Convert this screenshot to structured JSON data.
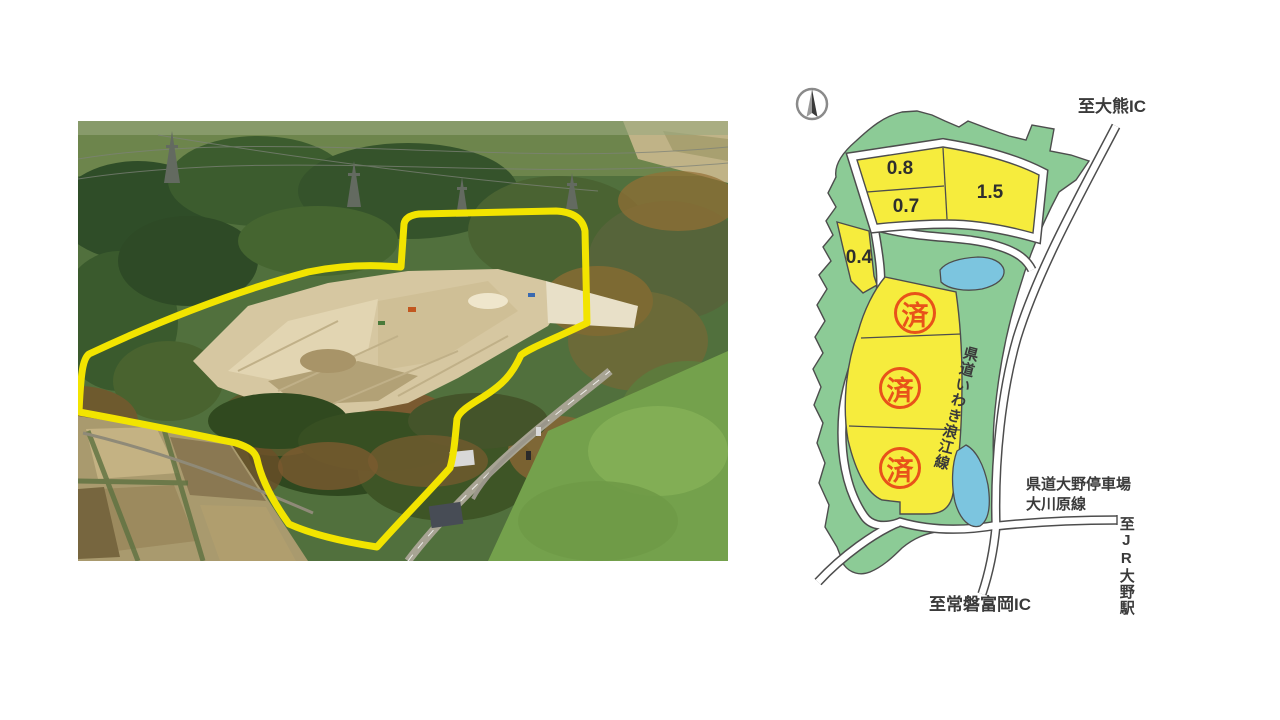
{
  "map": {
    "labels": {
      "to_okuma_ic": "至大熊IC",
      "road_iwaki_namie": "県道いわき浪江線",
      "road_ono_line1": "県道大野停車場",
      "road_ono_line2": "大川原線",
      "to_jr_ono": "至JR大野駅",
      "to_tomioka_ic": "至常磐富岡IC"
    },
    "plots": [
      {
        "label": "0.8"
      },
      {
        "label": "0.7"
      },
      {
        "label": "1.5"
      },
      {
        "label": "0.4"
      }
    ],
    "sold_plots": [
      "済",
      "済",
      "済"
    ],
    "colors": {
      "site_green": "#8ccb96",
      "plot_yellow": "#f6ec3d",
      "water_blue": "#7cc5df",
      "sold_red": "#e8521a",
      "road_white": "#ffffff",
      "outline_gray": "#4d4d4d",
      "photo_boundary_yellow": "#f2e400"
    }
  }
}
